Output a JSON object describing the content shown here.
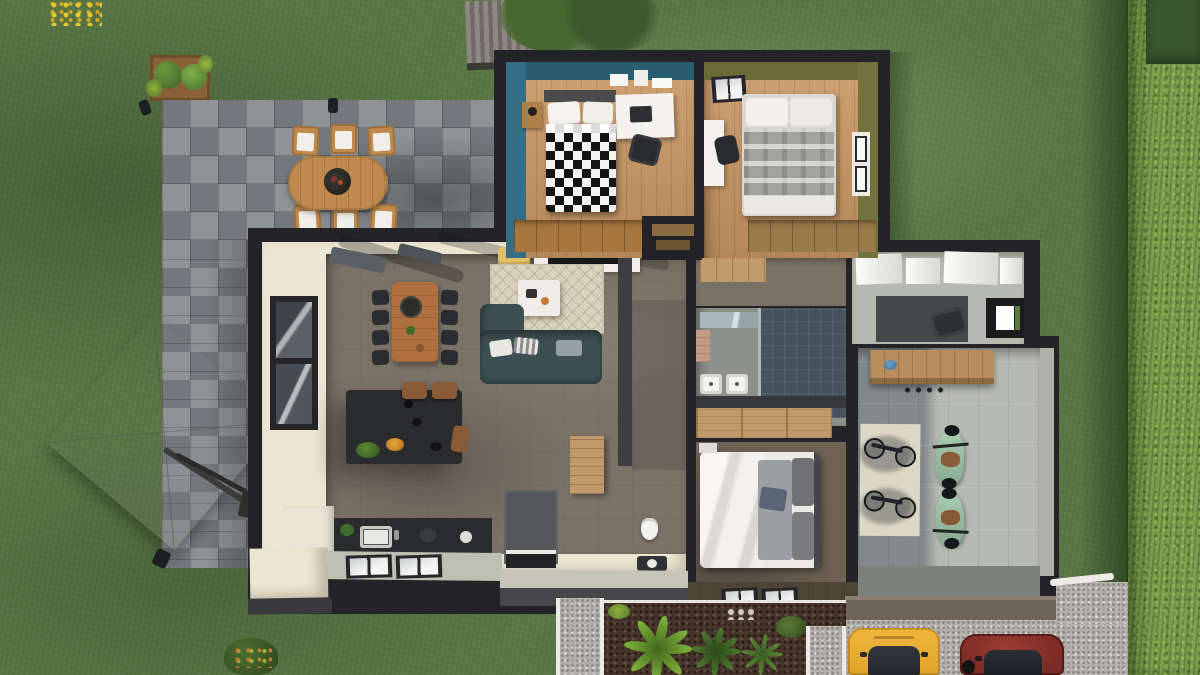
{
  "scene": {
    "type": "3d-floor-plan-render",
    "view": "top-down-aerial",
    "description": "Aerial 3D rendering of a single-storey house: living room with open kitchen, three bedrooms, bathroom, utility room and garage, surrounded by lawn, paved terrace with dining set and parasol, front garden with palms, gravel driveway with two parked cars and a tall hedge on the right"
  },
  "palette": {
    "lawn": "#5a7745",
    "hedge": "#7f9e4f",
    "hedgeShadow": "#22401c",
    "hedgeDark": "#39572e",
    "paving": "#84888c",
    "pavingDark": "#55595d",
    "wallDark": "#242428",
    "wallCream": "#ece7d3",
    "roofBandLight": "#bcbfb2",
    "floorLiving": "#7b7267",
    "floorWood": "#c49a6a",
    "floorMaster": "#6e6255",
    "tealWall": "#356e84",
    "oliveWall": "#72733c",
    "sofa": "#3e4f52",
    "rug": "#d8d1bb",
    "islandDark": "#2a2b2d",
    "woodFurniture": "#b06f3e",
    "patioWood": "#c08a4e",
    "stoolBrown": "#8a5a36",
    "yellowChair": "#e3c064",
    "bathTile": "#46525c",
    "vanityWood": "#c09a6a",
    "terracotta": "#c29a85",
    "officeFloor": "#b6b9af",
    "garageFloorLeft": "#838a8c",
    "garageFloorRight": "#b7bab2",
    "garageApron": "#7d817b",
    "garageWallBrown": "#6f6459",
    "gravel": "#b3b0aa",
    "mulch": "#47342a",
    "palm": "#7fb53b",
    "carYellow": "#dfa32c",
    "carRed": "#7c2b26",
    "motoMint": "#a9ccb3",
    "parasol": "#cecdc9",
    "skylight": "#f4f4f2",
    "bedWhite": "#eceae4",
    "duvetGray": "#a3a3a0",
    "entryFloor": "#56575b",
    "matBeige": "#ddd8c6",
    "shedGray": "#8d8881"
  },
  "objects": {
    "garden": [
      "lawn",
      "trimmed-hedge",
      "hedge-shadow",
      "planter-with-shrubs",
      "garden-shed",
      "tree-canopy",
      "yellow-flowers",
      "corner-shrub"
    ],
    "terrace": [
      "stone-paving",
      "oval-wood-dining-table",
      "six-wood-chairs",
      "charcoal-grill-tray",
      "square-parasol",
      "path-lights"
    ],
    "living_room": [
      "wood-dining-table",
      "eight-dark-chairs",
      "corner-sofa",
      "beige-rug",
      "coffee-table",
      "tv-sideboard",
      "yellow-armchair",
      "kitchen-island",
      "two-bar-stools",
      "kitchen-counter-with-sink",
      "roof-skylights",
      "front-door",
      "entry-mat",
      "wardrobe",
      "toilet",
      "hand-basin"
    ],
    "bedroom_teal": [
      "single-bed-checkered-duvet",
      "nightstand-with-lamp",
      "desk",
      "desk-chair",
      "dresser"
    ],
    "bedroom_olive": [
      "double-bed-gray-plaid-duvet",
      "desk",
      "desk-chair",
      "window",
      "skylight",
      "dresser"
    ],
    "bathroom": [
      "walk-in-shower-dark-tiles",
      "double-basin-vanity",
      "mirror",
      "towel-basket"
    ],
    "master_bedroom": [
      "double-bed-white-linen",
      "gray-pillows",
      "roof-skylights"
    ],
    "utility_room": [
      "white-cabinets",
      "desk-chair",
      "window"
    ],
    "garage": [
      "workbench",
      "blue-helmet",
      "two-bicycles",
      "bike-mat",
      "two-mint-motorcycles",
      "concrete-floor"
    ],
    "front_yard": [
      "gravel-paths-white-edging",
      "mulch-bed",
      "large-palm",
      "small-palms",
      "bushes",
      "stones"
    ],
    "driveway": [
      "gravel-surface",
      "white-curb",
      "yellow-sports-car",
      "dark-red-car"
    ]
  },
  "counts": {
    "bedrooms": 3,
    "terrace_chairs": 6,
    "bicycles": 2,
    "motorcycles": 2,
    "cars": 2,
    "skylights": 6
  }
}
